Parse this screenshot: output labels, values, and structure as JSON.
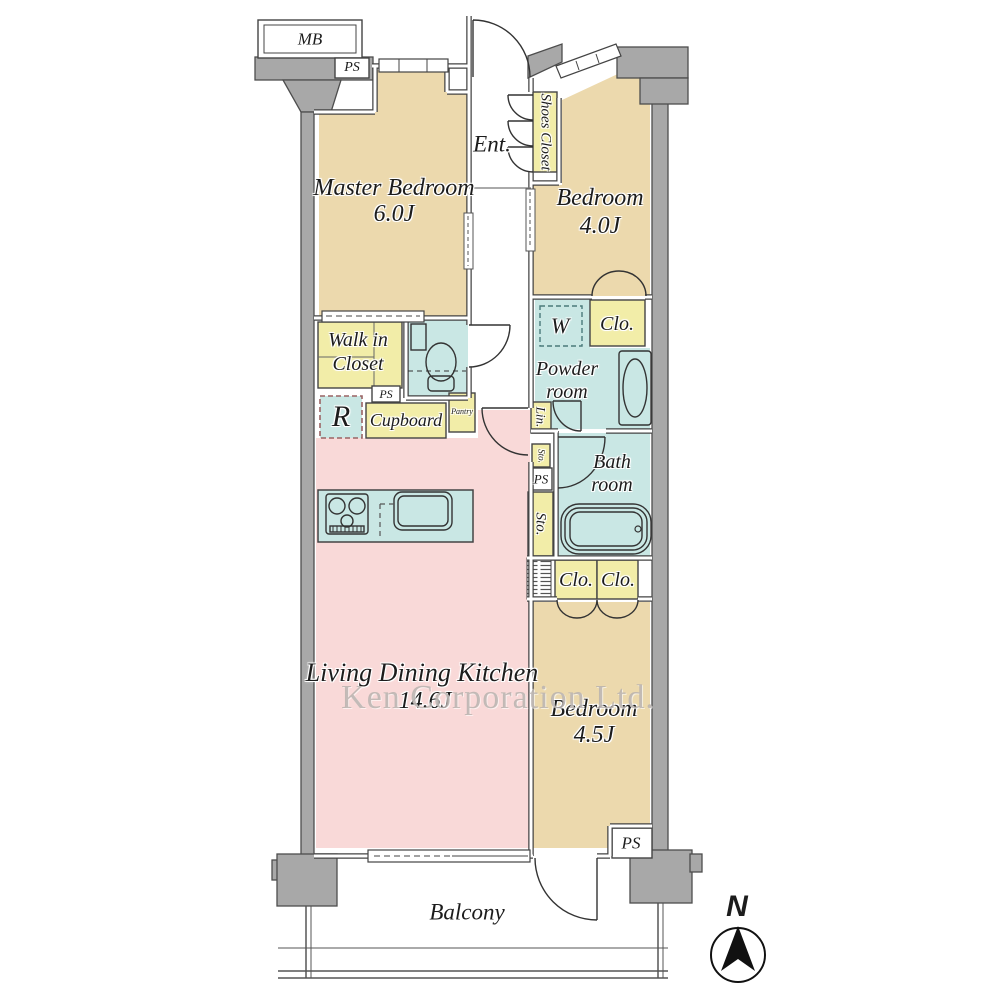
{
  "watermark": "Ken Corporation Ltd.",
  "compass": {
    "north": "N"
  },
  "rooms": {
    "master_bedroom": {
      "name": "Master Bedroom",
      "size": "6.0J"
    },
    "bedroom_2": {
      "name": "Bedroom",
      "size": "4.0J"
    },
    "bedroom_3": {
      "name": "Bedroom",
      "size": "4.5J"
    },
    "ldk": {
      "name": "Living Dining Kitchen",
      "size": "14.6J"
    },
    "entrance": {
      "name": "Ent."
    },
    "powder_room": {
      "line1": "Powder",
      "line2": "room"
    },
    "bath_room": {
      "line1": "Bath",
      "line2": "room"
    },
    "walk_in_closet": {
      "line1": "Walk in",
      "line2": "Closet"
    },
    "balcony": {
      "name": "Balcony"
    }
  },
  "storage": {
    "shoes_closet": "Shoes Closet",
    "closet_bedroom2": "Clo.",
    "closet_a": "Clo.",
    "closet_b": "Clo.",
    "cupboard": "Cupboard",
    "pantry": "Pantry",
    "linen": "Lin.",
    "storage_small": "Sto.",
    "storage_tall": "Sto."
  },
  "fixtures": {
    "washer": "W",
    "refrigerator": "R"
  },
  "service": {
    "meter_box": "MB",
    "pipe_space_1": "PS",
    "pipe_space_2": "PS",
    "pipe_space_3": "PS",
    "pipe_space_4": "PS"
  },
  "colors": {
    "bedroom": "#ecd9ad",
    "ldk": "#f9d9d8",
    "wet_area": "#c9e7e4",
    "storage": "#f2eda8",
    "wall_gray": "#a8a8a8",
    "line": "#444444",
    "white": "#ffffff"
  }
}
